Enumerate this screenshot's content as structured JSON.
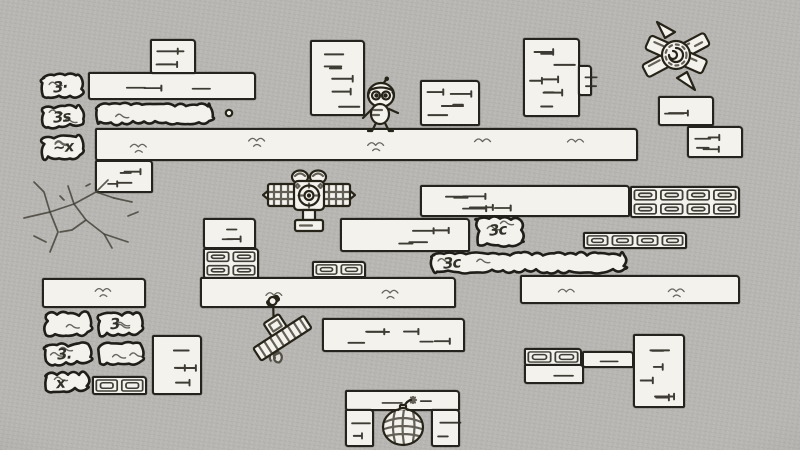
{
  "palette": {
    "paper": "#b7b5b1",
    "ink": "#26241e",
    "block_fill": "#f4f2ec",
    "label_ink": "#33322a"
  },
  "scene": {
    "blocks": [
      {
        "type": "bush",
        "x": 37,
        "y": 71,
        "w": 52,
        "h": 31,
        "label": "3·"
      },
      {
        "type": "bush",
        "x": 37,
        "y": 101,
        "w": 52,
        "h": 31,
        "label": "3s"
      },
      {
        "type": "bush",
        "x": 37,
        "y": 131,
        "w": 52,
        "h": 32,
        "label": "~x"
      },
      {
        "type": "brick",
        "x": 88,
        "y": 72,
        "w": 168,
        "h": 28
      },
      {
        "type": "brick",
        "x": 150,
        "y": 39,
        "w": 46,
        "h": 35
      },
      {
        "type": "bush",
        "x": 92,
        "y": 99,
        "w": 126,
        "h": 30
      },
      {
        "type": "platform",
        "x": 95,
        "y": 128,
        "w": 543,
        "h": 33
      },
      {
        "type": "brick",
        "x": 95,
        "y": 160,
        "w": 58,
        "h": 33
      },
      {
        "type": "brick",
        "x": 310,
        "y": 40,
        "w": 55,
        "h": 76
      },
      {
        "type": "brick",
        "x": 420,
        "y": 80,
        "w": 60,
        "h": 46
      },
      {
        "type": "brick",
        "x": 523,
        "y": 38,
        "w": 57,
        "h": 79
      },
      {
        "type": "brick",
        "x": 578,
        "y": 65,
        "w": 14,
        "h": 31
      },
      {
        "type": "brick",
        "x": 658,
        "y": 96,
        "w": 56,
        "h": 30
      },
      {
        "type": "brick",
        "x": 687,
        "y": 126,
        "w": 56,
        "h": 32
      },
      {
        "type": "brick",
        "x": 420,
        "y": 185,
        "w": 210,
        "h": 32
      },
      {
        "type": "metal",
        "x": 630,
        "y": 186,
        "w": 110,
        "h": 32
      },
      {
        "type": "brick",
        "x": 340,
        "y": 218,
        "w": 130,
        "h": 34
      },
      {
        "type": "bush",
        "x": 472,
        "y": 212,
        "w": 56,
        "h": 38,
        "label": "3c"
      },
      {
        "type": "metal",
        "x": 583,
        "y": 232,
        "w": 104,
        "h": 17
      },
      {
        "type": "bush",
        "x": 427,
        "y": 248,
        "w": 205,
        "h": 29,
        "label": "3c"
      },
      {
        "type": "platform",
        "x": 520,
        "y": 275,
        "w": 220,
        "h": 29
      },
      {
        "type": "brick",
        "x": 203,
        "y": 218,
        "w": 53,
        "h": 31
      },
      {
        "type": "metal",
        "x": 203,
        "y": 248,
        "w": 56,
        "h": 31
      },
      {
        "type": "metal",
        "x": 312,
        "y": 261,
        "w": 54,
        "h": 17
      },
      {
        "type": "platform",
        "x": 200,
        "y": 277,
        "w": 256,
        "h": 31
      },
      {
        "type": "platform",
        "x": 42,
        "y": 278,
        "w": 104,
        "h": 30
      },
      {
        "type": "bush",
        "x": 40,
        "y": 308,
        "w": 56,
        "h": 32
      },
      {
        "type": "bush",
        "x": 94,
        "y": 308,
        "w": 54,
        "h": 32,
        "label": "3"
      },
      {
        "type": "bush",
        "x": 40,
        "y": 339,
        "w": 56,
        "h": 30,
        "label": "3."
      },
      {
        "type": "bush",
        "x": 94,
        "y": 339,
        "w": 54,
        "h": 30
      },
      {
        "type": "bush",
        "x": 40,
        "y": 368,
        "w": 54,
        "h": 28,
        "label": "x"
      },
      {
        "type": "metal",
        "x": 92,
        "y": 376,
        "w": 55,
        "h": 19
      },
      {
        "type": "brick",
        "x": 152,
        "y": 335,
        "w": 50,
        "h": 60
      },
      {
        "type": "brick",
        "x": 322,
        "y": 318,
        "w": 143,
        "h": 34
      },
      {
        "type": "brick",
        "x": 345,
        "y": 390,
        "w": 115,
        "h": 21
      },
      {
        "type": "brick",
        "x": 345,
        "y": 409,
        "w": 29,
        "h": 38
      },
      {
        "type": "brick",
        "x": 431,
        "y": 409,
        "w": 29,
        "h": 38
      },
      {
        "type": "metal",
        "x": 524,
        "y": 348,
        "w": 58,
        "h": 18
      },
      {
        "type": "brick",
        "x": 524,
        "y": 364,
        "w": 60,
        "h": 20
      },
      {
        "type": "brick",
        "x": 582,
        "y": 351,
        "w": 52,
        "h": 17
      },
      {
        "type": "brick",
        "x": 633,
        "y": 334,
        "w": 52,
        "h": 74
      }
    ],
    "sprites": {
      "player": {
        "x": 360,
        "y": 78,
        "w": 42,
        "h": 55,
        "desc": "small round-headed character with antenna"
      },
      "saw": {
        "x": 637,
        "y": 20,
        "w": 78,
        "h": 72,
        "desc": "spinning saw-blade hazard"
      },
      "turret": {
        "x": 262,
        "y": 168,
        "w": 94,
        "h": 70,
        "desc": "crosshair turret machine on pedestal"
      },
      "bomb": {
        "x": 377,
        "y": 396,
        "w": 54,
        "h": 52,
        "desc": "round bomb with lit fuse inside brick alcove"
      },
      "cart": {
        "x": 236,
        "y": 292,
        "w": 82,
        "h": 72,
        "desc": "tilted pump cart with lever"
      },
      "crack": {
        "x": 16,
        "y": 172,
        "w": 140,
        "h": 92,
        "desc": "cracked wall decal"
      },
      "pebble": {
        "x": 224,
        "y": 108,
        "w": 10,
        "h": 10,
        "desc": "small dot pebble"
      }
    }
  }
}
